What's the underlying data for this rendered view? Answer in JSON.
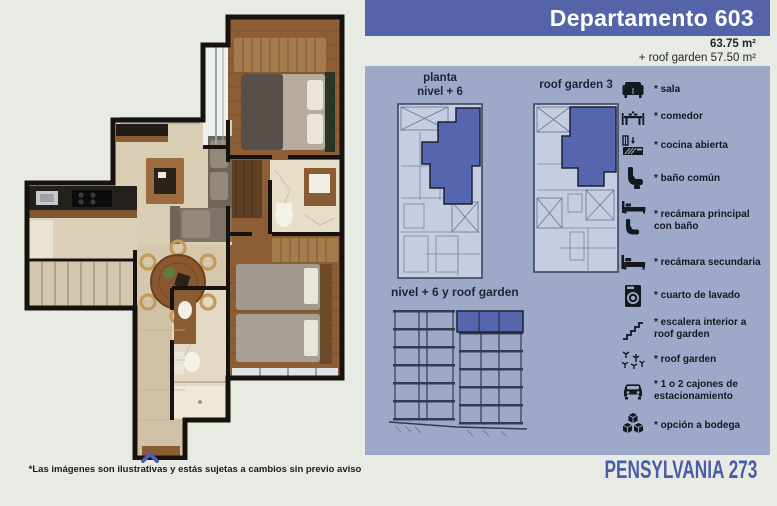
{
  "header": {
    "title": "Departamento 603"
  },
  "area": {
    "main": "63.75 m²",
    "roof": "+ roof garden 57.50 m²"
  },
  "plans": {
    "planta": {
      "title_line1": "planta",
      "title_line2": "nivel + 6"
    },
    "roof_garden": {
      "title": "roof garden 3"
    },
    "section": {
      "title": "nivel + 6 y roof garden"
    }
  },
  "legend": {
    "items": [
      {
        "icon": "sofa-icon",
        "label": "* sala"
      },
      {
        "icon": "dining-table-icon",
        "label": "* comedor"
      },
      {
        "icon": "kitchen-icon",
        "label": "* cocina abierta"
      },
      {
        "icon": "toilet-icon",
        "label": "* baño común"
      },
      {
        "icon": "bed-bath-icon",
        "label": "* recámara principal con baño"
      },
      {
        "icon": "bed-icon",
        "label": "* recámara secundaria"
      },
      {
        "icon": "washing-machine-icon",
        "label": "* cuarto de lavado"
      },
      {
        "icon": "stairs-icon",
        "label": "* escalera interior a roof garden"
      },
      {
        "icon": "roof-garden-icon",
        "label": "* roof garden"
      },
      {
        "icon": "car-icon",
        "label": "* 1 o 2 cajones de estacionamiento"
      },
      {
        "icon": "storage-boxes-icon",
        "label": "* opción a bodega"
      }
    ]
  },
  "footer": {
    "disclaimer": "*Las imágenes son ilustrativas y estás sujetas a cambios sin previo aviso",
    "brand": "PENSYLVANIA 273"
  },
  "colors": {
    "header_bg": "#5564a9",
    "panel_bg": "#9ea9ca",
    "plan_highlight": "#5565ae",
    "brand_text": "#4a5da8"
  }
}
